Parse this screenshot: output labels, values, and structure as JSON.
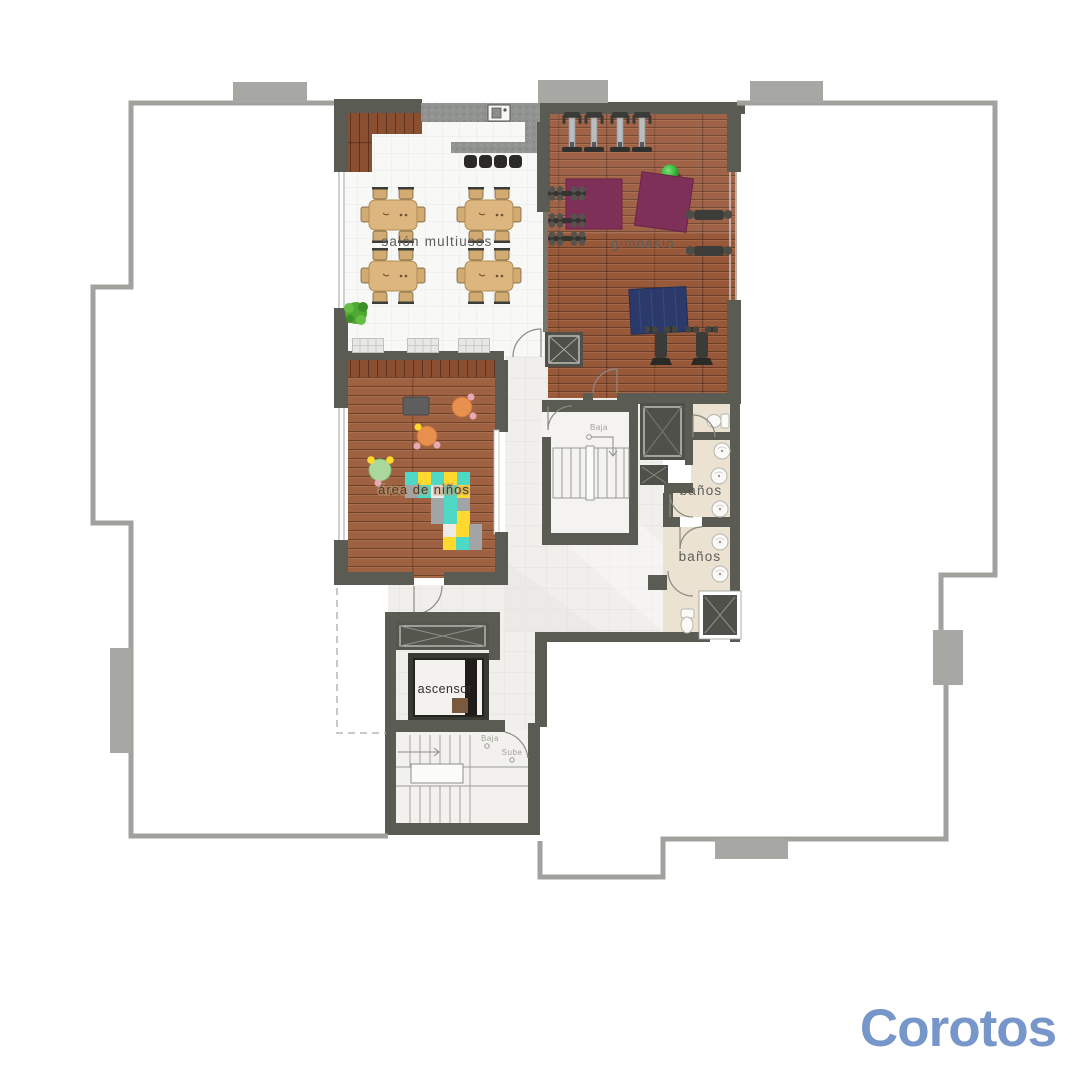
{
  "floorplan": {
    "rooms": [
      {
        "id": "salon",
        "label": "salón multiusos"
      },
      {
        "id": "gimnasio",
        "label": "gimnasio"
      },
      {
        "id": "area_ninos",
        "label": "área de niños"
      },
      {
        "id": "banos_upper",
        "label": "baños"
      },
      {
        "id": "banos_lower",
        "label": "baños"
      },
      {
        "id": "ascensor",
        "label": "ascensor"
      }
    ],
    "stair_annotations": {
      "upper_baja": "Baja",
      "lower_baja": "Baja",
      "lower_sube": "Sube"
    },
    "colors": {
      "wall": "#5a5b53",
      "outline": "#a1a19e",
      "wood_gym": "#98583a",
      "wood_kids": "#9e6242",
      "tile": "#f1f0ee",
      "cream": "#ebe2d2",
      "mat_purple": "#7e3058",
      "mat_blue": "#2c3a6b",
      "ball_green": "#35b93a",
      "kid_teal": "#4ed9c6",
      "kid_yellow": "#ffd92e",
      "table_tan": "#dcb67e",
      "table_orange": "#e8914f",
      "table_green": "#abd89c"
    }
  },
  "watermark": {
    "brand": "Corotos",
    "color": "#7796c9"
  }
}
